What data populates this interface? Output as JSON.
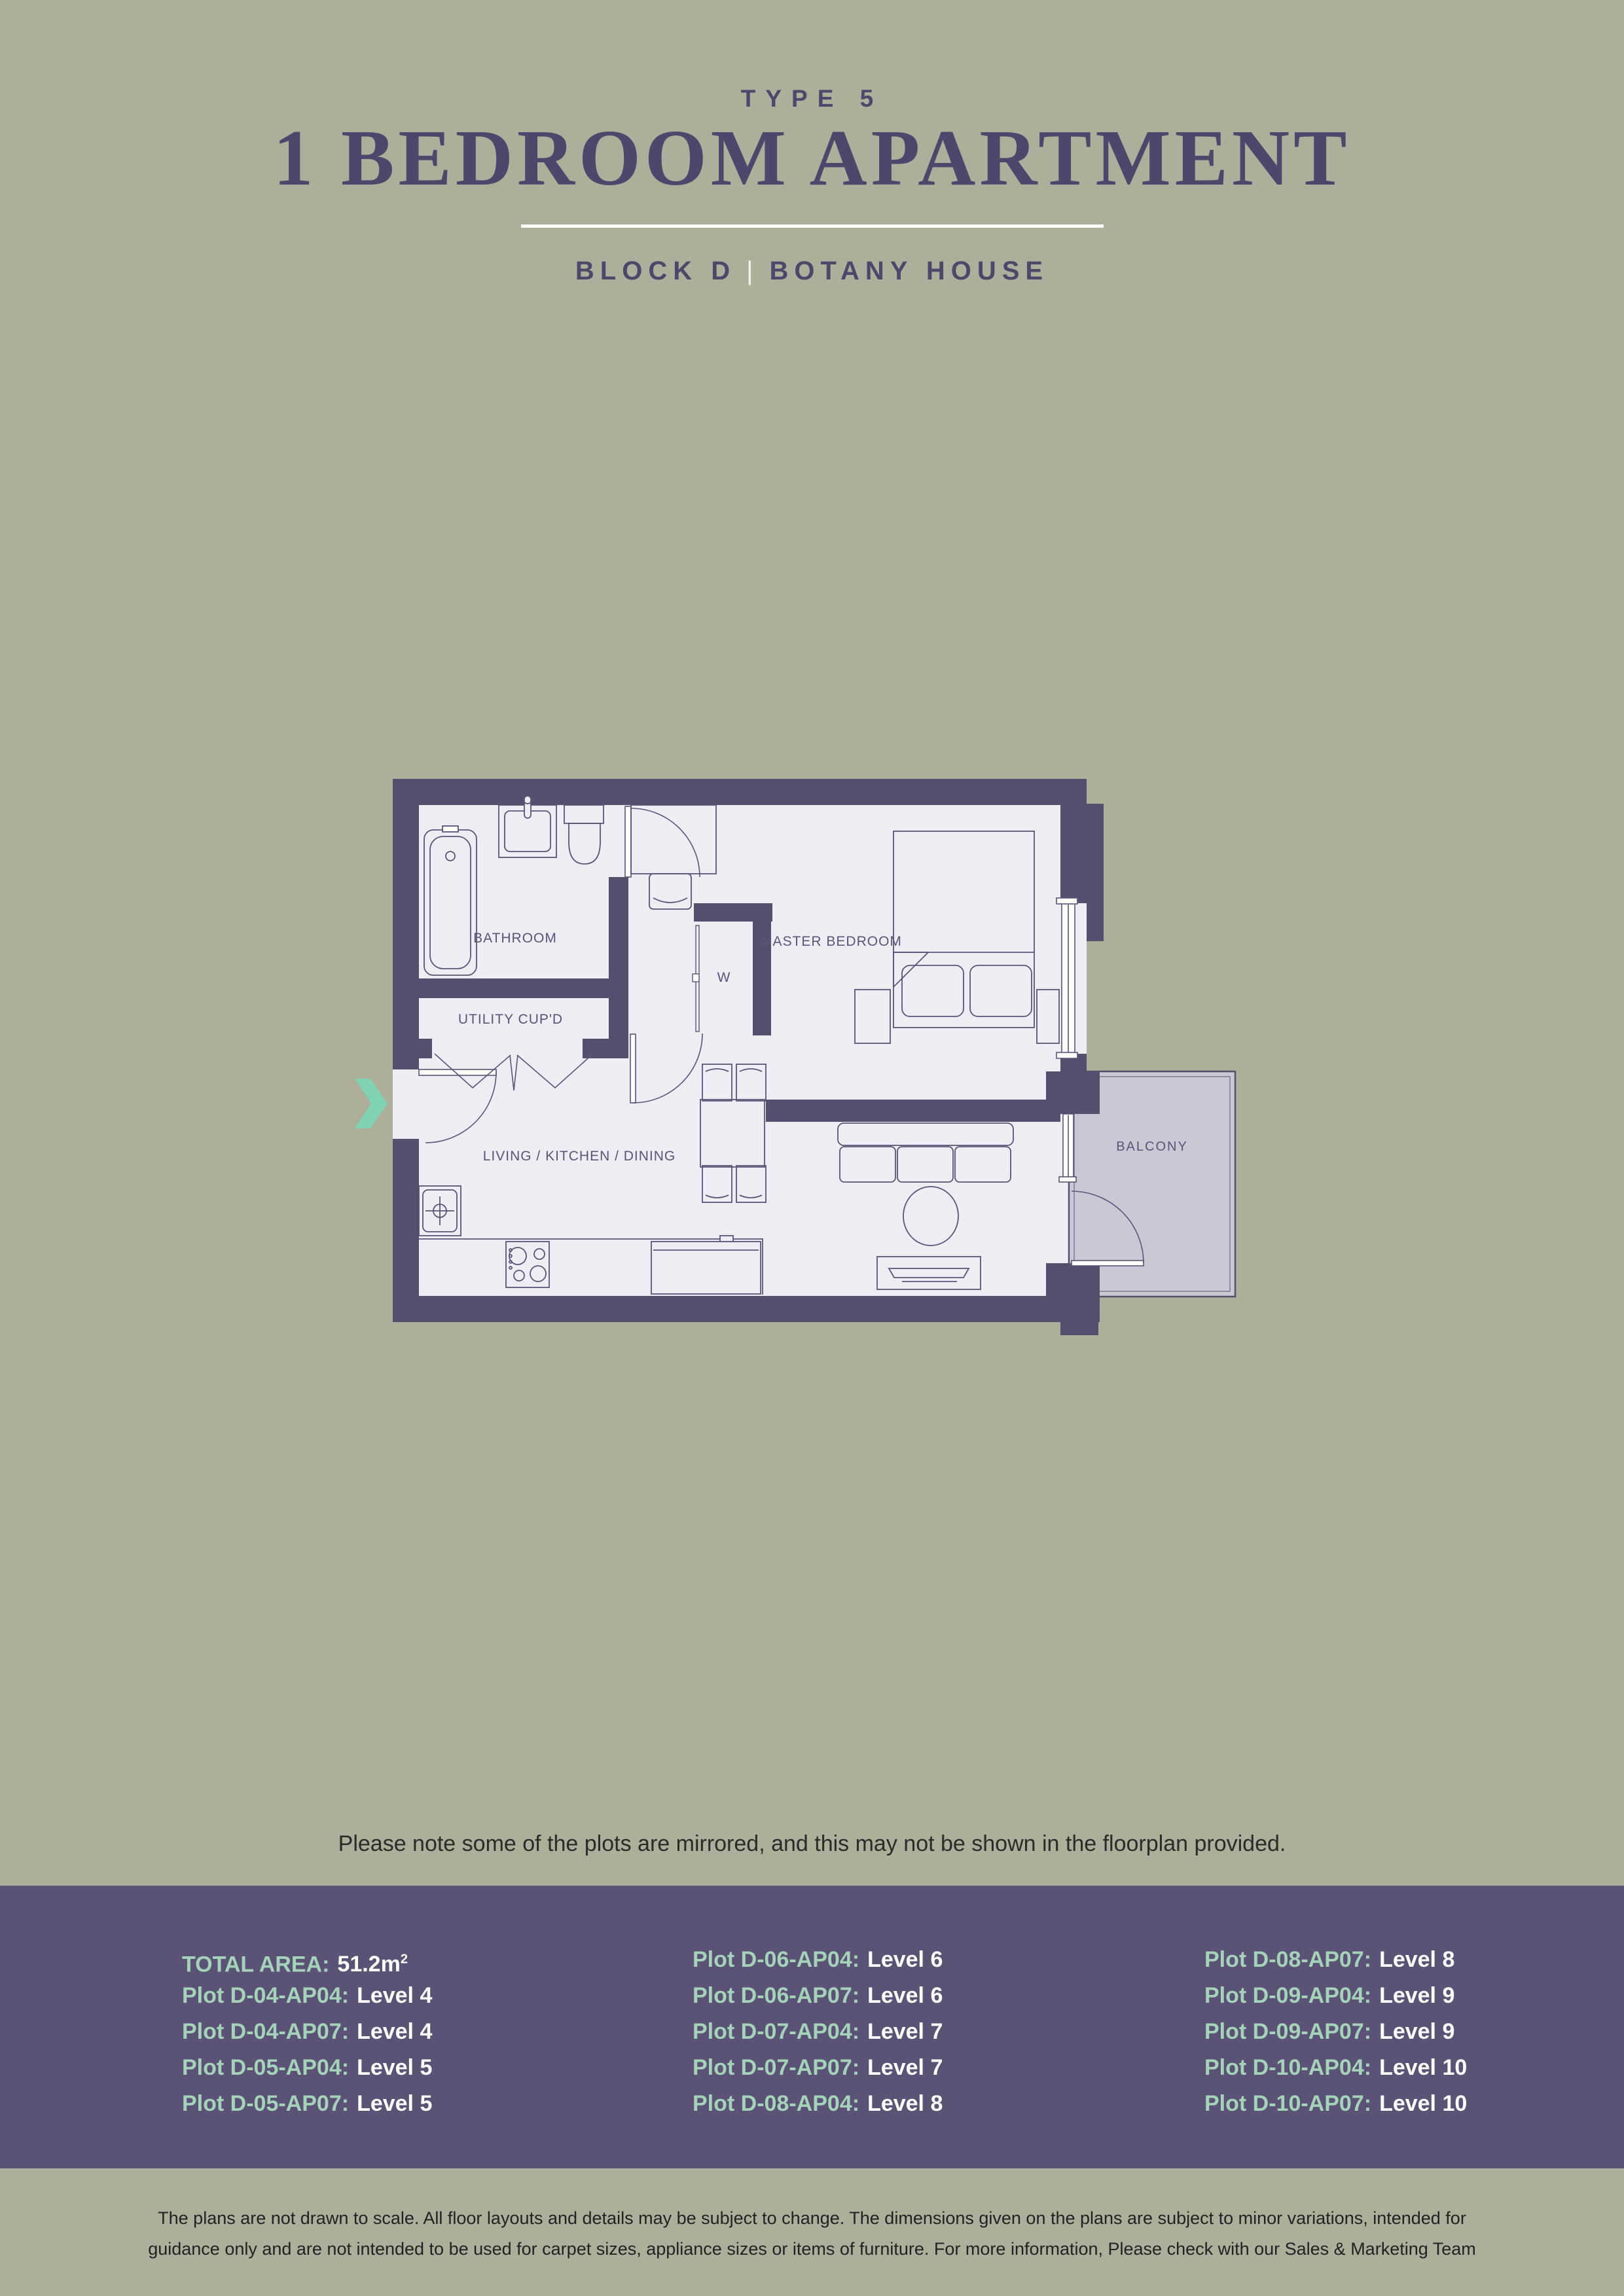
{
  "header": {
    "type_label": "TYPE 5",
    "title": "1 BEDROOM APARTMENT",
    "block": "BLOCK D",
    "pipe": "|",
    "house": "BOTANY HOUSE"
  },
  "floorplan": {
    "rooms": {
      "bathroom": "BATHROOM",
      "utility": "UTILITY CUP'D",
      "master_bedroom": "MASTER BEDROOM",
      "wardrobe": "W",
      "living": "LIVING / KITCHEN / DINING",
      "balcony": "BALCONY"
    },
    "icons": {
      "entry_arrow": "chevron-right"
    }
  },
  "note": "Please note some of the plots are mirrored, and this may not be shown in the floorplan provided.",
  "footer": {
    "total_area": {
      "label": "TOTAL AREA:",
      "value": "51.2m",
      "sup": "2"
    },
    "columns": [
      [
        {
          "label": "Plot D-04-AP04:",
          "value": "Level 4"
        },
        {
          "label": "Plot D-04-AP07:",
          "value": "Level 4"
        },
        {
          "label": "Plot D-05-AP04:",
          "value": "Level 5"
        },
        {
          "label": "Plot D-05-AP07:",
          "value": "Level 5"
        }
      ],
      [
        {
          "label": "Plot D-06-AP04:",
          "value": "Level 6"
        },
        {
          "label": "Plot D-06-AP07:",
          "value": "Level 6"
        },
        {
          "label": "Plot D-07-AP04:",
          "value": "Level 7"
        },
        {
          "label": "Plot D-07-AP07:",
          "value": "Level 7"
        },
        {
          "label": "Plot D-08-AP04:",
          "value": "Level 8"
        }
      ],
      [
        {
          "label": "Plot D-08-AP07:",
          "value": "Level 8"
        },
        {
          "label": "Plot D-09-AP04:",
          "value": "Level 9"
        },
        {
          "label": "Plot D-09-AP07:",
          "value": "Level 9"
        },
        {
          "label": "Plot D-10-AP04:",
          "value": "Level 10"
        },
        {
          "label": "Plot D-10-AP07:",
          "value": "Level 10"
        }
      ]
    ]
  },
  "disclaimer": {
    "line1": "The plans are not drawn to scale. All floor layouts and details may be subject to change. The dimensions given on the plans are subject to minor variations, intended for",
    "line2": "guidance only and are not intended to be used for carpet sizes, appliance sizes or items of furniture. For more information, Please check with our Sales & Marketing Team"
  },
  "colors": {
    "background": "#adaf9a",
    "band_purple": "#5a5375",
    "heading_purple": "#4d486b",
    "wall_purple": "#554f6e",
    "floor": "#eeedf3",
    "balcony_fill": "#cac8d5",
    "mint_label": "#a5d3ba",
    "mint_arrow": "#7fd3b2",
    "value_white": "#ffffff",
    "divider_white": "#ffffff"
  }
}
